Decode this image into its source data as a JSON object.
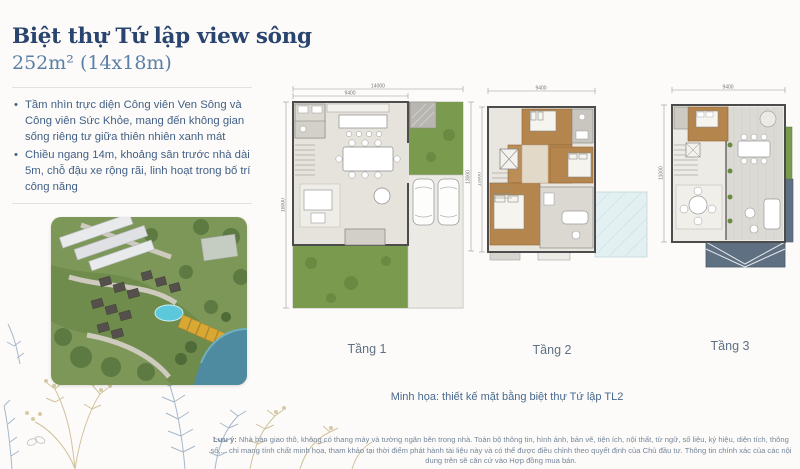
{
  "header": {
    "title": "Biệt thự Tứ lập view sông",
    "subtitle": "252m² (14x18m)"
  },
  "intro": {
    "bullets": [
      "Tầm nhìn trực diện Công viên Ven Sông và Công viên Sức Khỏe, mang đến không gian sống riêng tư giữa thiên nhiên xanh mát",
      "Chiều ngang 14m, khoảng sân trước nhà dài 5m, chỗ đậu xe rộng rãi, linh hoạt trong bố trí công năng"
    ],
    "bullet_glyph": "•"
  },
  "plans": [
    {
      "label": "Tầng 1",
      "dims": {
        "top_overall": "14000",
        "top_inner": "9400",
        "left": "18000",
        "right": "13000"
      }
    },
    {
      "label": "Tầng 2",
      "dims": {
        "top": "9400",
        "left": "13000"
      }
    },
    {
      "label": "Tầng 3",
      "dims": {
        "top": "9400",
        "left": "11000"
      }
    }
  ],
  "caption": "Minh họa: thiết kế mặt bằng biệt thự Tứ lập TL2",
  "footnote": {
    "label": "Lưu ý:",
    "text": "Nhà bàn giao thô, không có thang máy và tường ngăn bên trong nhà. Toàn bộ thông tin, hình ảnh, bản vẽ, tiện ích, nội thất, từ ngữ, số liệu, ký hiệu, diện tích, thông số,... chỉ mang tính chất minh họa, tham khảo tại thời điểm phát hành tài liệu này và có thể được điều chỉnh theo quyết định của Chủ đầu tư. Thông tin chính xác của các nội dung trên sẽ căn cứ vào Hợp đồng mua bán."
  },
  "colors": {
    "title_navy": "#29456f",
    "steel_blue": "#5a80a8",
    "body_blue": "#415f86",
    "lawn_green": "#7a9b4e",
    "wood_brown": "#b5854e",
    "highlight_gold": "#d9a833",
    "roof_slate": "#5f7082",
    "skylight_blue": "#e2f0f2",
    "pool_blue": "#5bc8dc",
    "river_teal": "#4e8ba0"
  }
}
